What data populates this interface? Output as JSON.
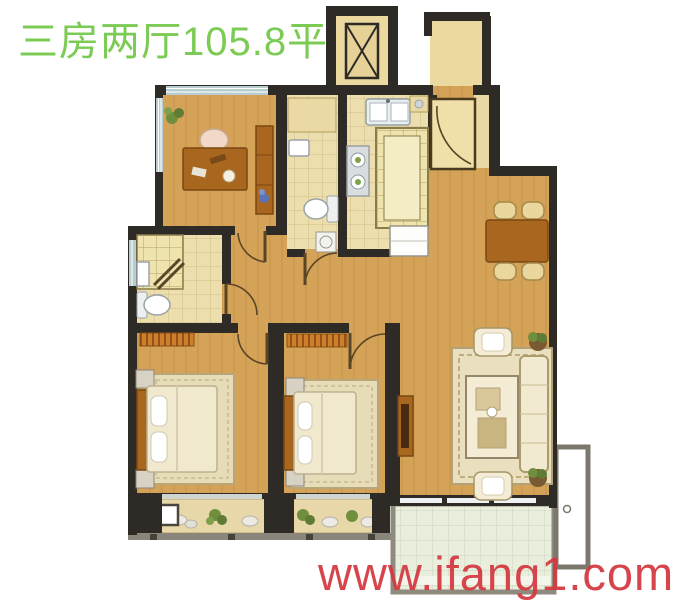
{
  "title": {
    "text": "三房两厅105.8平"
  },
  "watermark": {
    "text": "www.ifang1.com"
  },
  "colors": {
    "title_green": "#7ccb55",
    "watermark_red": "#d4383f",
    "wall_dark": "#2e2b26",
    "wall_gray": "#8a867c",
    "wood_floor": "#d5a357",
    "tile_floor": "#ecdfad",
    "glass_blue": "#b7cdd0",
    "furniture_brown": "#a9661f",
    "cream": "#f0e9ce",
    "rug_beige": "#e7dcb8",
    "balcony_green": "#e9efdc",
    "plant_green": "#6f8f3f"
  }
}
